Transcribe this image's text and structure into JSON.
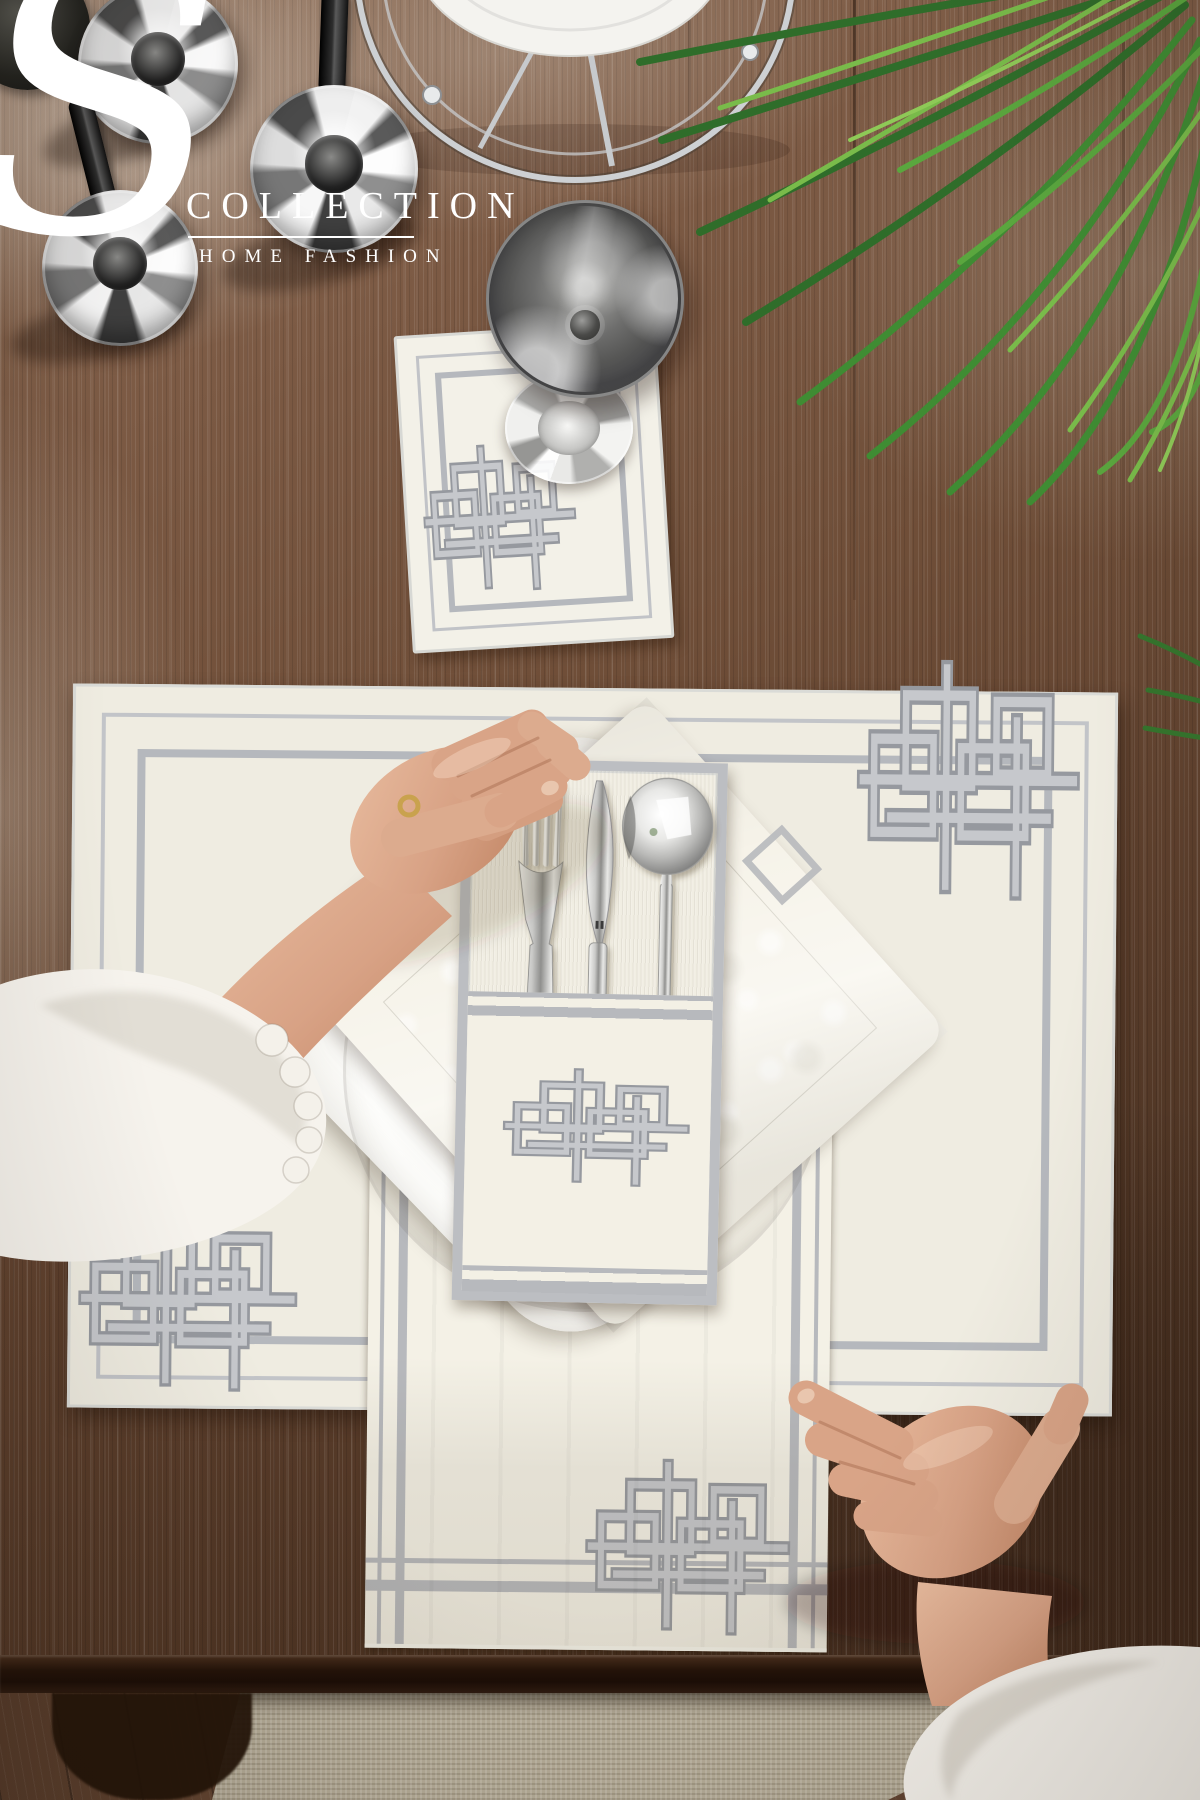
{
  "brand": {
    "initial": "S",
    "name": "COLLECTION",
    "subtitle": "HOME FASHION"
  },
  "palette": {
    "wood": "#7a5740",
    "wood_dark": "#432b1c",
    "fabric_cream": "#f2efe4",
    "embroidery_silver": "#b7b9bd",
    "trim_gray": "#bcbec2",
    "leaf_green": "#4f9a38",
    "chrome": "#d9dadb",
    "smoked_glass": "#565655",
    "skin": "#d8a285",
    "rug": "#b4ab97",
    "floor_wood": "#5f4230",
    "logo_white": "#ffffff"
  },
  "scene": {
    "description": "Top-down product photo of an embroidered table linen set on a weathered wood table",
    "objects": [
      {
        "label": "weathered wood table top"
      },
      {
        "label": "chrome candlesticks with black candles"
      },
      {
        "label": "chrome cake stand with white plate"
      },
      {
        "label": "green palm leaves"
      },
      {
        "label": "embroidered coaster"
      },
      {
        "label": "smoked glass goblet"
      },
      {
        "label": "embroidered placemat with geometric knot corners"
      },
      {
        "label": "white square dinner plate"
      },
      {
        "label": "damask napkin"
      },
      {
        "label": "embroidered cutlery holder with fork, knife and spoon"
      },
      {
        "label": "embroidered table runner hanging over table edge"
      },
      {
        "label": "left hand adjusting cutlery holder"
      },
      {
        "label": "right hand touching placemat corner"
      },
      {
        "label": "beige woven rug"
      },
      {
        "label": "wooden floor"
      }
    ]
  }
}
